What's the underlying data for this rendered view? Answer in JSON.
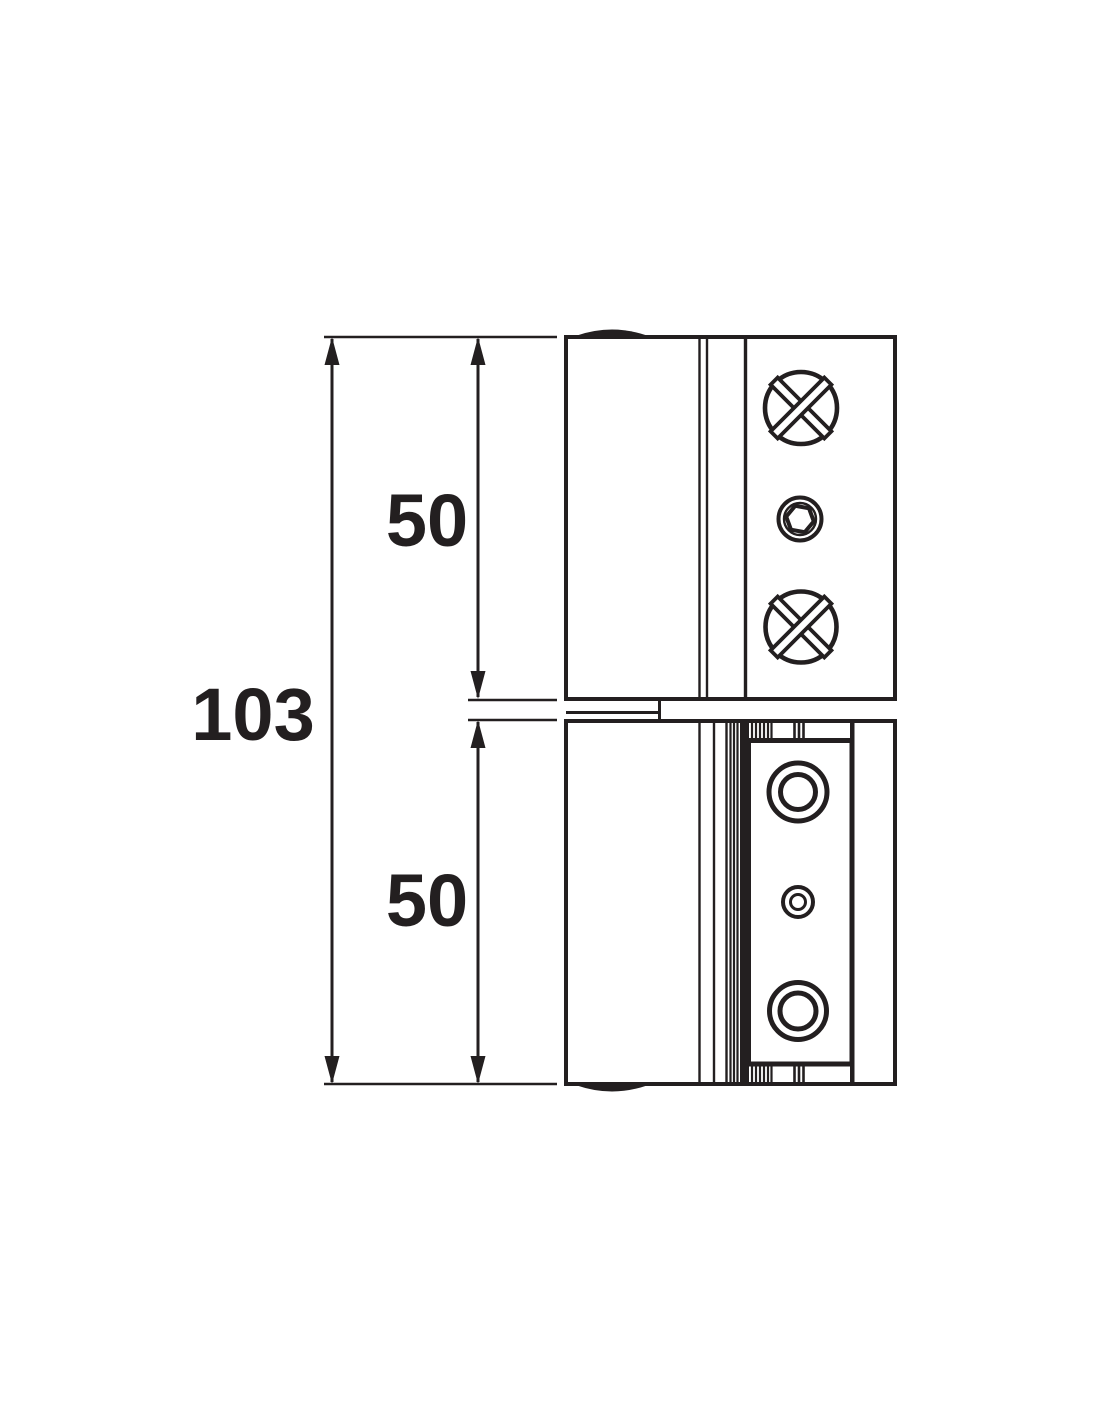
{
  "drawing": {
    "type": "technical-dimension-drawing",
    "subject": "door-hinge-side-elevation",
    "dimension_labels": {
      "total": "103",
      "upper": "50",
      "lower": "50"
    },
    "colors": {
      "ink": "#231f20",
      "background": "#ffffff"
    }
  }
}
